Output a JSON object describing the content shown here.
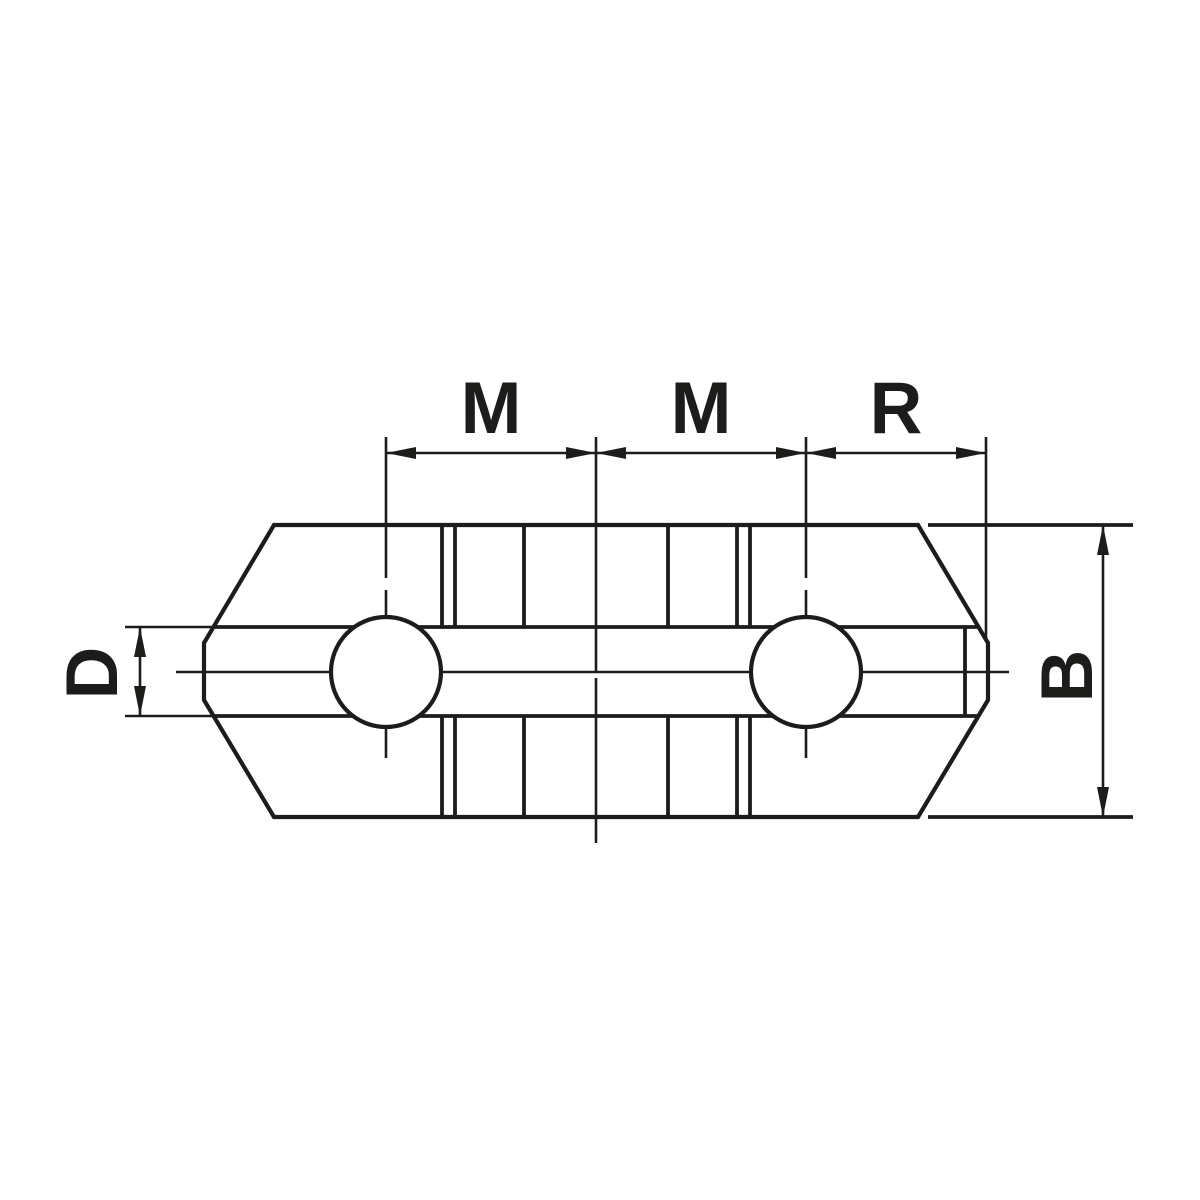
{
  "drawing": {
    "description": "Technical dimension drawing of a lathe chuck top jaw, plan view",
    "labels": {
      "m_left": "M",
      "m_right": "M",
      "r": "R",
      "d": "D",
      "b": "B"
    },
    "style": {
      "line_color": "#1c1c1a",
      "background_color": "#ffffff"
    }
  }
}
